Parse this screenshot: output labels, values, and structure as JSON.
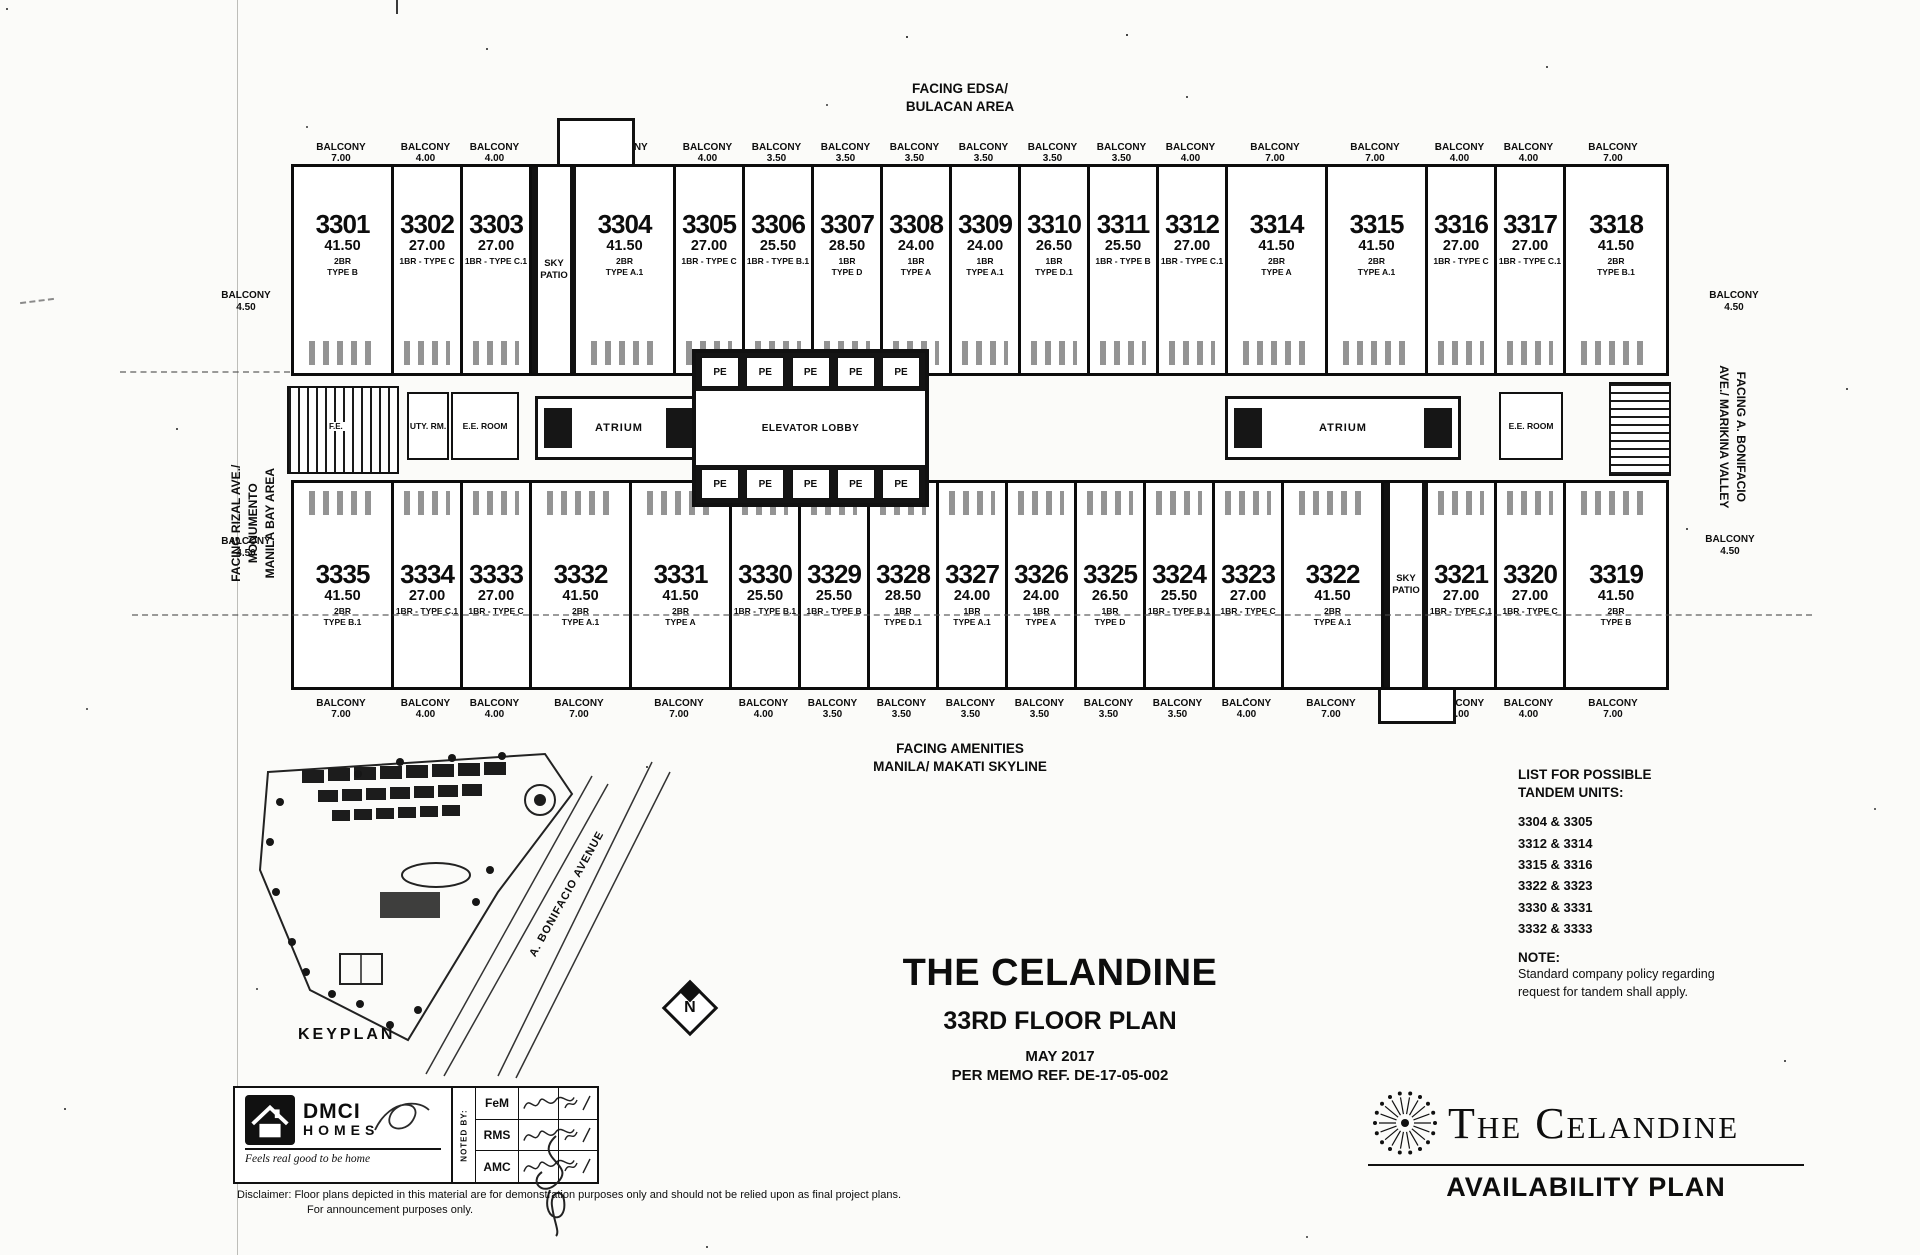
{
  "facing": {
    "top1": "FACING EDSA/",
    "top2": "BULACAN AREA",
    "bottom1": "FACING AMENITIES",
    "bottom2": "MANILA/ MAKATI SKYLINE"
  },
  "plan": {
    "balcony_word": "BALCONY",
    "side_balcony": {
      "label": "BALCONY",
      "value": "4.50"
    },
    "facing_left": [
      "FACING RIZAL AVE./",
      "MONUMENTO",
      "MANILA BAY AREA"
    ],
    "facing_right": [
      "FACING A. BONIFACIO",
      "AVE./ MARIKINA VALLEY"
    ],
    "top_balconies": [
      "7.00",
      "4.00",
      "4.00",
      null,
      "7.00",
      "4.00",
      "3.50",
      "3.50",
      "3.50",
      "3.50",
      "3.50",
      "3.50",
      "4.00",
      "7.00",
      "7.00",
      "4.00",
      "4.00",
      "7.00"
    ],
    "bottom_balconies": [
      "7.00",
      "4.00",
      "4.00",
      "7.00",
      "7.00",
      "4.00",
      "3.50",
      "3.50",
      "3.50",
      "3.50",
      "3.50",
      "3.50",
      "4.00",
      "7.00",
      null,
      "4.00",
      "4.00",
      "7.00"
    ],
    "top_row": [
      {
        "no": "3301",
        "area": "41.50",
        "type": "2BR TYPE B",
        "wide": true
      },
      {
        "no": "3302",
        "area": "27.00",
        "type": "1BR - TYPE C"
      },
      {
        "no": "3303",
        "area": "27.00",
        "type": "1BR - TYPE C.1"
      },
      {
        "special": "SKY PATIO"
      },
      {
        "no": "3304",
        "area": "41.50",
        "type": "2BR TYPE A.1",
        "wide": true
      },
      {
        "no": "3305",
        "area": "27.00",
        "type": "1BR - TYPE C"
      },
      {
        "no": "3306",
        "area": "25.50",
        "type": "1BR - TYPE B.1"
      },
      {
        "no": "3307",
        "area": "28.50",
        "type": "1BR TYPE D"
      },
      {
        "no": "3308",
        "area": "24.00",
        "type": "1BR TYPE A"
      },
      {
        "no": "3309",
        "area": "24.00",
        "type": "1BR TYPE A.1"
      },
      {
        "no": "3310",
        "area": "26.50",
        "type": "1BR TYPE D.1"
      },
      {
        "no": "3311",
        "area": "25.50",
        "type": "1BR - TYPE B"
      },
      {
        "no": "3312",
        "area": "27.00",
        "type": "1BR - TYPE C.1"
      },
      {
        "no": "3314",
        "area": "41.50",
        "type": "2BR TYPE A",
        "wide": true
      },
      {
        "no": "3315",
        "area": "41.50",
        "type": "2BR TYPE A.1",
        "wide": true
      },
      {
        "no": "3316",
        "area": "27.00",
        "type": "1BR - TYPE C"
      },
      {
        "no": "3317",
        "area": "27.00",
        "type": "1BR - TYPE C.1"
      },
      {
        "no": "3318",
        "area": "41.50",
        "type": "2BR TYPE B.1",
        "wide": true
      }
    ],
    "bottom_row": [
      {
        "no": "3335",
        "area": "41.50",
        "type": "2BR TYPE B.1",
        "wide": true
      },
      {
        "no": "3334",
        "area": "27.00",
        "type": "1BR - TYPE C.1"
      },
      {
        "no": "3333",
        "area": "27.00",
        "type": "1BR - TYPE C"
      },
      {
        "no": "3332",
        "area": "41.50",
        "type": "2BR TYPE A.1",
        "wide": true
      },
      {
        "no": "3331",
        "area": "41.50",
        "type": "2BR TYPE A",
        "wide": true
      },
      {
        "no": "3330",
        "area": "25.50",
        "type": "1BR - TYPE B.1"
      },
      {
        "no": "3329",
        "area": "25.50",
        "type": "1BR - TYPE B"
      },
      {
        "no": "3328",
        "area": "28.50",
        "type": "1BR TYPE D.1"
      },
      {
        "no": "3327",
        "area": "24.00",
        "type": "1BR TYPE A.1"
      },
      {
        "no": "3326",
        "area": "24.00",
        "type": "1BR TYPE A"
      },
      {
        "no": "3325",
        "area": "26.50",
        "type": "1BR TYPE D"
      },
      {
        "no": "3324",
        "area": "25.50",
        "type": "1BR - TYPE B.1"
      },
      {
        "no": "3323",
        "area": "27.00",
        "type": "1BR - TYPE C"
      },
      {
        "no": "3322",
        "area": "41.50",
        "type": "2BR TYPE A.1",
        "wide": true
      },
      {
        "special": "SKY PATIO"
      },
      {
        "no": "3321",
        "area": "27.00",
        "type": "1BR - TYPE C.1"
      },
      {
        "no": "3320",
        "area": "27.00",
        "type": "1BR - TYPE C"
      },
      {
        "no": "3319",
        "area": "41.50",
        "type": "2BR TYPE B",
        "wide": true
      }
    ],
    "core": {
      "atrium": "ATRIUM",
      "elevator_lobby": "ELEVATOR LOBBY",
      "pe": "PE",
      "ee_room": "E.E. ROOM",
      "uty": "UTY. RM.",
      "fe": "F.E."
    }
  },
  "keyplan": {
    "label": "KEYPLAN",
    "street": "A. BONIFACIO AVENUE",
    "north": "N"
  },
  "tandem": {
    "title1": "LIST FOR POSSIBLE",
    "title2": "TANDEM UNITS:",
    "pairs": [
      "3304 & 3305",
      "3312 & 3314",
      "3315 & 3316",
      "3322 & 3323",
      "3330 & 3331",
      "3332 & 3333"
    ]
  },
  "note": {
    "label": "NOTE:",
    "line1": "Standard company policy regarding",
    "line2": "request for tandem shall apply."
  },
  "title_block": {
    "project": "THE CELANDINE",
    "plan": "33RD FLOOR PLAN",
    "date": "MAY 2017",
    "memo": "PER MEMO REF. DE-17-05-002"
  },
  "dmci": {
    "name1": "DMCI",
    "name2": "HOMES",
    "tagline": "Feels real good to be home"
  },
  "noted_by": {
    "label": "NOTED BY:",
    "rows": [
      "FeM",
      "RMS",
      "AMC"
    ]
  },
  "disclaimer": {
    "line1": "Disclaimer:  Floor plans depicted in this material are for demonstration purposes only and should not be relied upon as final project plans.",
    "line2": "For announcement purposes only."
  },
  "brand": {
    "name": "The Celandine",
    "plan_label": "AVAILABILITY PLAN"
  }
}
